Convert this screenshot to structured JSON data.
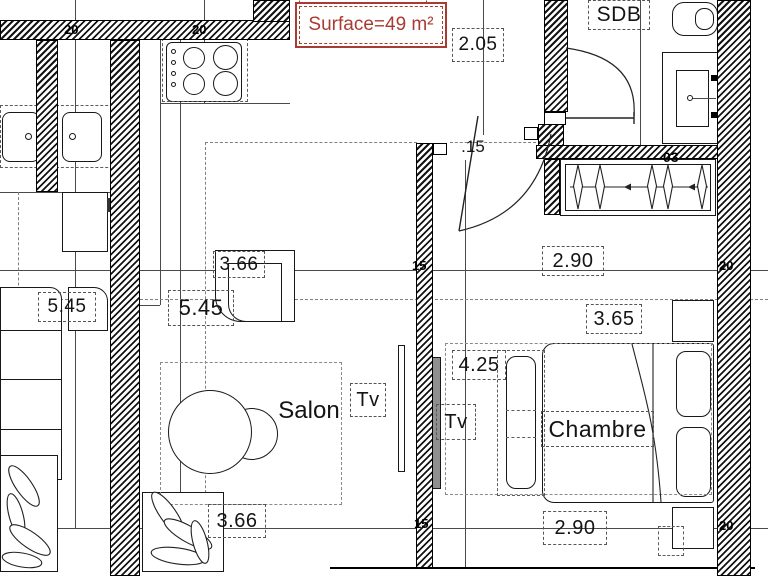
{
  "surface": {
    "label": "Surface=49 m²"
  },
  "rooms": {
    "salon": "Salon",
    "chambre": "Chambre",
    "sdb": "SDB"
  },
  "fixtures": {
    "tv_salon": "Tv",
    "tv_chambre": "Tv"
  },
  "dimensions": {
    "entry_width": "2.05",
    "partition_thickness": ".15",
    "dressing_width": "2.90",
    "salon_depth": "5.45",
    "neighbor_salon_depth": "5.45",
    "salon_feature": "3.66",
    "bed_width": "3.65",
    "chambre_depth": "4.25",
    "salon_width": "3.66",
    "chambre_width": "2.90"
  },
  "wall_labels": {
    "top_a": "20",
    "top_b": "20",
    "partition_a": "15",
    "partition_b": "15",
    "right_a": "20",
    "right_b": "20",
    "dressing": "03"
  },
  "colors": {
    "accent_red": "#A93B32",
    "wall_black": "#141414",
    "dash_gray": "#5a5a5a"
  }
}
